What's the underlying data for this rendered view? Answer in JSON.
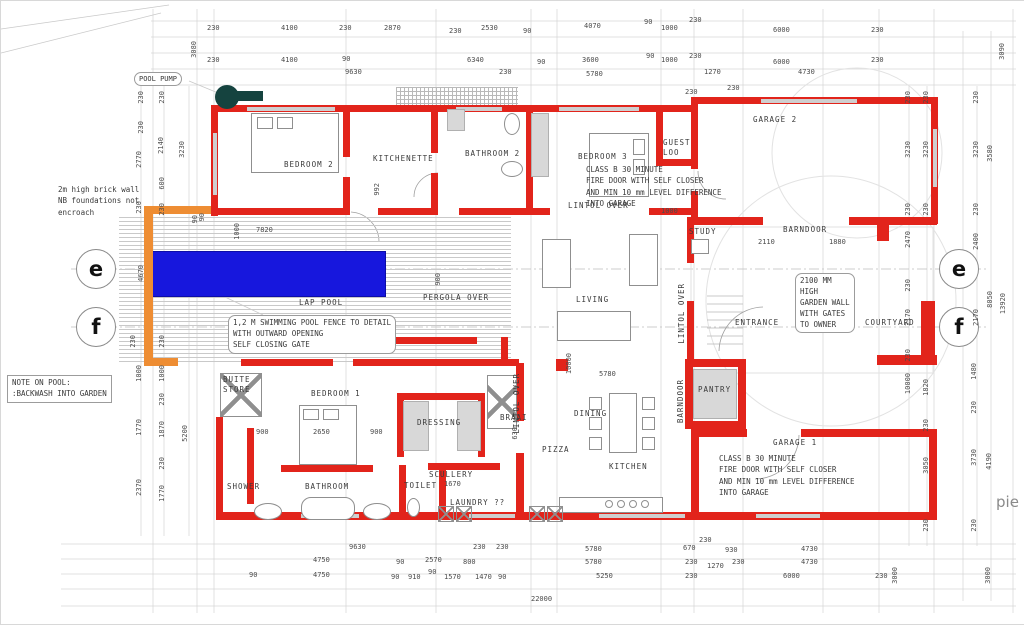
{
  "plan": {
    "rooms": {
      "bedroom2": "BEDROOM 2",
      "kitchenette": "KITCHENETTE",
      "bathroom2": "BATHROOM 2",
      "bedroom3": "BEDROOM 3",
      "guest_loo_1": "GUEST",
      "guest_loo_2": "LOO",
      "garage2": "GARAGE 2",
      "study": "STUDY",
      "barndoor_h": "BARNDOOR",
      "barndoor_v": "BARNDOOR",
      "lintol_over": "LINTOL OVER",
      "living": "LIVING",
      "lap_pool": "LAP POOL",
      "pergola_over": "PERGOLA OVER",
      "buite_1": "BUITE",
      "buite_2": "STORE",
      "bedroom1": "BEDROOM 1",
      "dressing": "DRESSING",
      "shower": "SHOWER",
      "bathroom": "BATHROOM",
      "toilet": "TOILET",
      "scullery": "SCULLERY",
      "laundry": "LAUNDRY ??",
      "braai": "BRAAI",
      "pizza": "PIZZA",
      "dining": "DINING",
      "kitchen": "KITCHEN",
      "pantry": "PANTRY",
      "garage1": "GARAGE 1",
      "entrance": "ENTRANCE",
      "courtyard": "COURTYARD"
    },
    "notes": {
      "pool_pump": "POOL PUMP",
      "brick_wall": [
        "2m high brick wall",
        "NB foundations not",
        "encroach"
      ],
      "pool_note": [
        "NOTE ON POOL:",
        ":BACKWASH INTO GARDEN"
      ],
      "fence": [
        "1,2 M SWIMMING POOL FENCE TO DETAIL",
        "WITH OUTWARD OPENING",
        "SELF CLOSING GATE"
      ],
      "garden_wall": [
        "2100 MM",
        "HIGH",
        "GARDEN WALL",
        "WITH GATES",
        "TO OWNER"
      ],
      "fire_door": [
        "CLASS B 30 MINUTE",
        "FIRE DOOR WITH SELF CLOSER",
        "AND MIN 10 mm LEVEL DIFFERENCE",
        "INTO GARAGE"
      ]
    },
    "markers": {
      "e": "e",
      "f": "f"
    },
    "watermark": "pie",
    "colors": {
      "wall_red": "#e2241b",
      "boundary_orange": "#ee8d33",
      "pool_blue": "#1717dd",
      "pump_teal": "#15433f"
    },
    "dims": [
      "230",
      "4100",
      "230",
      "2870",
      "230",
      "2530",
      "90",
      "4070",
      "90",
      "1000",
      "230",
      "6000",
      "230",
      "230",
      "4100",
      "90",
      "9630",
      "6340",
      "230",
      "90",
      "3600",
      "5780",
      "90",
      "1000",
      "230",
      "1270",
      "230",
      "230",
      "6000",
      "4730",
      "230",
      "3080",
      "3090",
      "230",
      "230",
      "2770",
      "230",
      "4670",
      "230",
      "1000",
      "1770",
      "2370",
      "230",
      "2140",
      "600",
      "230",
      "230",
      "1000",
      "230",
      "1870",
      "230",
      "1770",
      "3230",
      "90",
      "5200",
      "230",
      "3230",
      "230",
      "2470",
      "230",
      "2170",
      "230",
      "10000",
      "230",
      "3230",
      "230",
      "1820",
      "230",
      "3050",
      "230",
      "230",
      "3230",
      "230",
      "2400",
      "2170",
      "1480",
      "230",
      "3730",
      "230",
      "3580",
      "8050",
      "13920",
      "4190",
      "3000",
      "3000",
      "9630",
      "230",
      "230",
      "5780",
      "230",
      "670",
      "930",
      "4730",
      "4750",
      "90",
      "2570",
      "800",
      "5780",
      "230",
      "1270",
      "230",
      "4730",
      "90",
      "4750",
      "90",
      "910",
      "90",
      "1570",
      "1470",
      "90",
      "5250",
      "230",
      "6000",
      "230",
      "22000",
      "7820",
      "1000",
      "992",
      "1000",
      "2110",
      "1880",
      "10000",
      "5780",
      "900",
      "2650",
      "900",
      "1670",
      "630",
      "900",
      "90"
    ]
  }
}
